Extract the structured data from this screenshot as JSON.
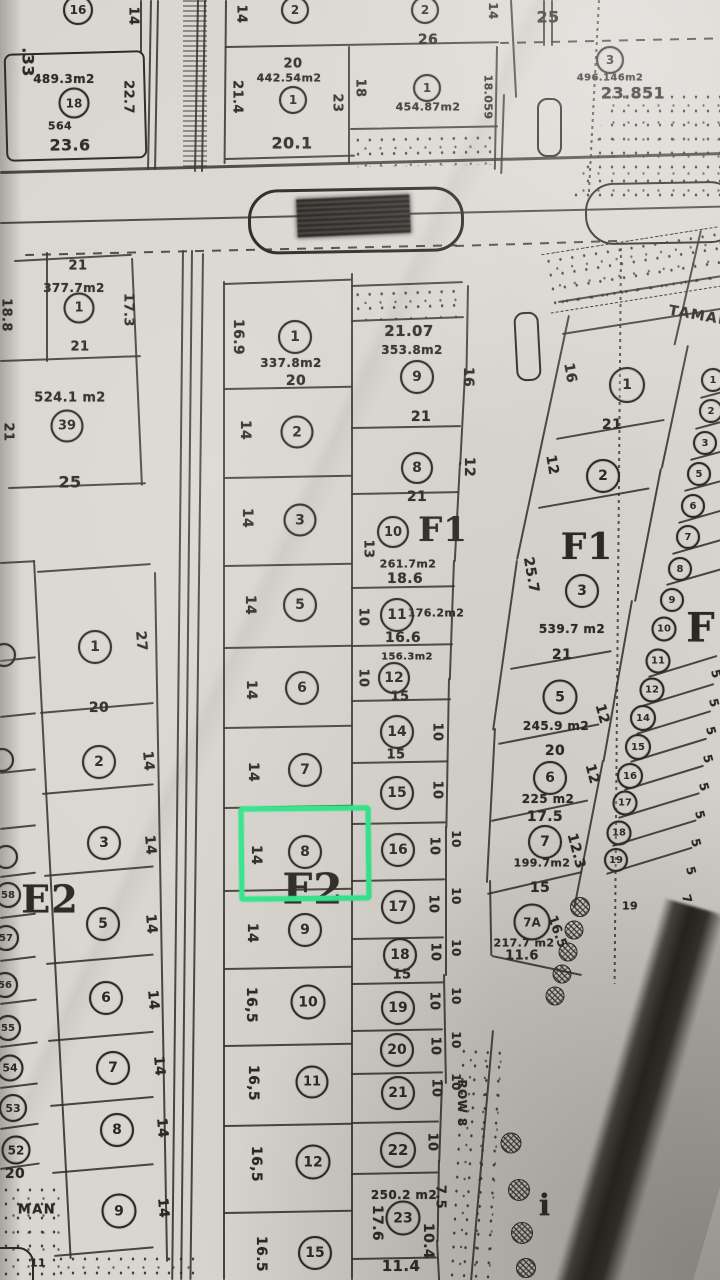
{
  "colors": {
    "paper": "#d9d6d0",
    "ink": "#2b2823",
    "highlight": "#2fe98b"
  },
  "highlight": {
    "plot": "8",
    "x": 239,
    "y": 806,
    "w": 122,
    "h": 85
  },
  "street": {
    "name_top": "TAMAN",
    "name_bottom_fragment": "MAN",
    "row_label": "ROW 8"
  },
  "texts": [
    {
      "t": ".33",
      "x": 28,
      "y": 62,
      "r": 90,
      "s": 16
    },
    {
      "t": "14",
      "x": 133,
      "y": 16,
      "r": 90,
      "s": 13
    },
    {
      "t": "489.3m2",
      "x": 64,
      "y": 79,
      "s": 12
    },
    {
      "t": "564",
      "x": 60,
      "y": 126,
      "s": 11
    },
    {
      "t": "23.6",
      "x": 70,
      "y": 145,
      "s": 16
    },
    {
      "t": "22.7",
      "x": 128,
      "y": 97,
      "r": 90,
      "s": 13
    },
    {
      "t": "21.4",
      "x": 237,
      "y": 97,
      "r": 90,
      "s": 13
    },
    {
      "t": "14",
      "x": 241,
      "y": 14,
      "r": 90,
      "s": 13
    },
    {
      "t": "26",
      "x": 428,
      "y": 40,
      "s": 14
    },
    {
      "t": "20",
      "x": 293,
      "y": 64,
      "s": 13
    },
    {
      "t": "442.54m2",
      "x": 289,
      "y": 78,
      "s": 11
    },
    {
      "t": "23",
      "x": 337,
      "y": 103,
      "r": 90,
      "s": 13
    },
    {
      "t": "20.1",
      "x": 292,
      "y": 143,
      "s": 16
    },
    {
      "t": "18",
      "x": 360,
      "y": 88,
      "r": 90,
      "s": 13
    },
    {
      "t": "454.87m2",
      "x": 428,
      "y": 107,
      "s": 11
    },
    {
      "t": "18.059",
      "x": 488,
      "y": 97,
      "r": 90,
      "s": 11
    },
    {
      "t": "14",
      "x": 493,
      "y": 11,
      "r": 90,
      "s": 12
    },
    {
      "t": "25",
      "x": 548,
      "y": 17,
      "s": 16
    },
    {
      "t": "496.146m2",
      "x": 610,
      "y": 78,
      "s": 10
    },
    {
      "t": "23.851",
      "x": 633,
      "y": 93,
      "s": 16
    },
    {
      "t": "21",
      "x": 78,
      "y": 266,
      "s": 13
    },
    {
      "t": "377.7m2",
      "x": 74,
      "y": 288,
      "s": 12
    },
    {
      "t": "17.3",
      "x": 128,
      "y": 310,
      "r": 90,
      "s": 13
    },
    {
      "t": "18.8",
      "x": 6,
      "y": 315,
      "r": 90,
      "s": 13
    },
    {
      "t": "21",
      "x": 80,
      "y": 347,
      "s": 13
    },
    {
      "t": "524.1 m2",
      "x": 70,
      "y": 398,
      "s": 13
    },
    {
      "t": "21",
      "x": 8,
      "y": 432,
      "r": 90,
      "s": 13
    },
    {
      "t": "25",
      "x": 70,
      "y": 482,
      "s": 16
    },
    {
      "t": "16.9",
      "x": 238,
      "y": 337,
      "r": 90,
      "s": 14
    },
    {
      "t": "337.8m2",
      "x": 291,
      "y": 363,
      "s": 12
    },
    {
      "t": "20",
      "x": 296,
      "y": 381,
      "s": 14
    },
    {
      "t": "14",
      "x": 245,
      "y": 430,
      "r": 90,
      "s": 14
    },
    {
      "t": "14",
      "x": 247,
      "y": 518,
      "r": 90,
      "s": 14
    },
    {
      "t": "14",
      "x": 250,
      "y": 605,
      "r": 90,
      "s": 14
    },
    {
      "t": "14",
      "x": 251,
      "y": 690,
      "r": 90,
      "s": 14
    },
    {
      "t": "14",
      "x": 253,
      "y": 772,
      "r": 90,
      "s": 14
    },
    {
      "t": "14",
      "x": 256,
      "y": 855,
      "r": 90,
      "s": 14
    },
    {
      "t": "14",
      "x": 252,
      "y": 933,
      "r": 90,
      "s": 14
    },
    {
      "t": "16,5",
      "x": 251,
      "y": 1005,
      "r": 90,
      "s": 14
    },
    {
      "t": "16,5",
      "x": 253,
      "y": 1083,
      "r": 90,
      "s": 14
    },
    {
      "t": "16,5",
      "x": 256,
      "y": 1164,
      "r": 90,
      "s": 14
    },
    {
      "t": "16.5",
      "x": 261,
      "y": 1254,
      "r": 90,
      "s": 14
    },
    {
      "t": "21.07",
      "x": 409,
      "y": 331,
      "s": 15
    },
    {
      "t": "353.8m2",
      "x": 412,
      "y": 350,
      "s": 12
    },
    {
      "t": "16",
      "x": 468,
      "y": 377,
      "r": 90,
      "s": 14
    },
    {
      "t": "21",
      "x": 421,
      "y": 417,
      "s": 14
    },
    {
      "t": "12",
      "x": 469,
      "y": 467,
      "r": 90,
      "s": 14
    },
    {
      "t": "21",
      "x": 417,
      "y": 497,
      "s": 14
    },
    {
      "t": "13",
      "x": 368,
      "y": 549,
      "r": 90,
      "s": 13
    },
    {
      "t": "261.7m2",
      "x": 408,
      "y": 564,
      "s": 11
    },
    {
      "t": "18.6",
      "x": 405,
      "y": 579,
      "s": 14
    },
    {
      "t": "176.2m2",
      "x": 436,
      "y": 613,
      "s": 11
    },
    {
      "t": "10",
      "x": 363,
      "y": 617,
      "r": 90,
      "s": 13
    },
    {
      "t": "16.6",
      "x": 403,
      "y": 638,
      "s": 14
    },
    {
      "t": "156.3m2",
      "x": 407,
      "y": 657,
      "s": 10
    },
    {
      "t": "10",
      "x": 363,
      "y": 678,
      "r": 90,
      "s": 13
    },
    {
      "t": "15",
      "x": 400,
      "y": 697,
      "s": 13
    },
    {
      "t": "10",
      "x": 437,
      "y": 732,
      "r": 90,
      "s": 13
    },
    {
      "t": "15",
      "x": 396,
      "y": 755,
      "s": 13
    },
    {
      "t": "10",
      "x": 437,
      "y": 790,
      "r": 90,
      "s": 13
    },
    {
      "t": "10",
      "x": 434,
      "y": 846,
      "r": 90,
      "s": 13
    },
    {
      "t": "10",
      "x": 456,
      "y": 839,
      "r": 90,
      "s": 12
    },
    {
      "t": "10",
      "x": 433,
      "y": 904,
      "r": 90,
      "s": 13
    },
    {
      "t": "10",
      "x": 456,
      "y": 896,
      "r": 90,
      "s": 12
    },
    {
      "t": "15",
      "x": 402,
      "y": 975,
      "s": 13
    },
    {
      "t": "10",
      "x": 435,
      "y": 952,
      "r": 90,
      "s": 13
    },
    {
      "t": "10",
      "x": 456,
      "y": 948,
      "r": 90,
      "s": 12
    },
    {
      "t": "10",
      "x": 434,
      "y": 1001,
      "r": 90,
      "s": 13
    },
    {
      "t": "10",
      "x": 456,
      "y": 996,
      "r": 90,
      "s": 12
    },
    {
      "t": "10",
      "x": 435,
      "y": 1046,
      "r": 90,
      "s": 13
    },
    {
      "t": "10",
      "x": 456,
      "y": 1040,
      "r": 90,
      "s": 12
    },
    {
      "t": "10",
      "x": 436,
      "y": 1088,
      "r": 90,
      "s": 13
    },
    {
      "t": "10",
      "x": 456,
      "y": 1082,
      "r": 90,
      "s": 12
    },
    {
      "t": "10",
      "x": 432,
      "y": 1142,
      "r": 90,
      "s": 13
    },
    {
      "t": "250.2 m2",
      "x": 404,
      "y": 1195,
      "s": 12
    },
    {
      "t": "7.5",
      "x": 440,
      "y": 1197,
      "r": 90,
      "s": 13
    },
    {
      "t": "17.6",
      "x": 377,
      "y": 1223,
      "r": 90,
      "s": 14
    },
    {
      "t": "10.4",
      "x": 428,
      "y": 1241,
      "r": 90,
      "s": 14
    },
    {
      "t": "11.4",
      "x": 401,
      "y": 1266,
      "s": 15
    },
    {
      "t": "ROW 8",
      "x": 462,
      "y": 1103,
      "r": 90,
      "s": 12
    },
    {
      "t": "TAMAN",
      "x": 700,
      "y": 316,
      "r": 10,
      "s": 14,
      "c": "street"
    },
    {
      "t": "16",
      "x": 570,
      "y": 373,
      "r": 80,
      "s": 14
    },
    {
      "t": "21",
      "x": 612,
      "y": 425,
      "s": 14
    },
    {
      "t": "12",
      "x": 552,
      "y": 465,
      "r": 80,
      "s": 14
    },
    {
      "t": "25.7",
      "x": 531,
      "y": 575,
      "r": 80,
      "s": 14
    },
    {
      "t": "539.7 m2",
      "x": 572,
      "y": 629,
      "s": 12
    },
    {
      "t": "21",
      "x": 562,
      "y": 655,
      "s": 14
    },
    {
      "t": "245.9 m2",
      "x": 556,
      "y": 726,
      "s": 12
    },
    {
      "t": "12",
      "x": 602,
      "y": 714,
      "r": 75,
      "s": 14
    },
    {
      "t": "20",
      "x": 555,
      "y": 751,
      "s": 14
    },
    {
      "t": "12",
      "x": 592,
      "y": 774,
      "r": 75,
      "s": 14
    },
    {
      "t": "225 m2",
      "x": 548,
      "y": 799,
      "s": 12
    },
    {
      "t": "17.5",
      "x": 545,
      "y": 817,
      "s": 14
    },
    {
      "t": "199.7m2",
      "x": 542,
      "y": 863,
      "s": 11
    },
    {
      "t": "12.3",
      "x": 576,
      "y": 851,
      "r": 75,
      "s": 14
    },
    {
      "t": "15",
      "x": 540,
      "y": 888,
      "s": 14
    },
    {
      "t": "217.7 m2",
      "x": 524,
      "y": 943,
      "s": 11
    },
    {
      "t": "11.6",
      "x": 522,
      "y": 956,
      "s": 13
    },
    {
      "t": "16.5",
      "x": 557,
      "y": 932,
      "r": 70,
      "s": 13
    },
    {
      "t": "19",
      "x": 630,
      "y": 906,
      "s": 11
    },
    {
      "t": "MAN",
      "x": 37,
      "y": 1210,
      "s": 13,
      "c": "street"
    },
    {
      "t": "20",
      "x": 15,
      "y": 1174,
      "s": 14
    },
    {
      "t": "11",
      "x": 38,
      "y": 1263,
      "s": 11
    },
    {
      "t": "27",
      "x": 141,
      "y": 641,
      "r": 85,
      "s": 14
    },
    {
      "t": "20",
      "x": 99,
      "y": 708,
      "s": 14
    },
    {
      "t": "14",
      "x": 148,
      "y": 761,
      "r": 85,
      "s": 14
    },
    {
      "t": "14",
      "x": 150,
      "y": 845,
      "r": 85,
      "s": 14
    },
    {
      "t": "14",
      "x": 151,
      "y": 924,
      "r": 85,
      "s": 14
    },
    {
      "t": "14",
      "x": 153,
      "y": 1000,
      "r": 85,
      "s": 14
    },
    {
      "t": "14",
      "x": 159,
      "y": 1066,
      "r": 85,
      "s": 14
    },
    {
      "t": "14",
      "x": 162,
      "y": 1128,
      "r": 85,
      "s": 14
    },
    {
      "t": "14",
      "x": 163,
      "y": 1208,
      "r": 85,
      "s": 14
    },
    {
      "t": "5",
      "x": 716,
      "y": 674,
      "r": 75,
      "s": 12
    },
    {
      "t": "5",
      "x": 714,
      "y": 703,
      "r": 75,
      "s": 12
    },
    {
      "t": "5",
      "x": 711,
      "y": 731,
      "r": 75,
      "s": 12
    },
    {
      "t": "5",
      "x": 708,
      "y": 759,
      "r": 75,
      "s": 12
    },
    {
      "t": "5",
      "x": 704,
      "y": 787,
      "r": 75,
      "s": 12
    },
    {
      "t": "5",
      "x": 700,
      "y": 815,
      "r": 75,
      "s": 12
    },
    {
      "t": "5",
      "x": 696,
      "y": 843,
      "r": 75,
      "s": 12
    },
    {
      "t": "5",
      "x": 691,
      "y": 871,
      "r": 75,
      "s": 12
    },
    {
      "t": "7",
      "x": 687,
      "y": 899,
      "r": 75,
      "s": 12
    },
    {
      "t": "E2",
      "x": 50,
      "y": 899,
      "s": 38,
      "c": "big"
    },
    {
      "t": "F2",
      "x": 313,
      "y": 889,
      "s": 42,
      "c": "big"
    },
    {
      "t": "F1",
      "x": 443,
      "y": 530,
      "s": 34,
      "c": "big"
    },
    {
      "t": "F1",
      "x": 587,
      "y": 547,
      "s": 36,
      "c": "big"
    },
    {
      "t": "F",
      "x": 701,
      "y": 628,
      "s": 40,
      "c": "big"
    },
    {
      "t": "i",
      "x": 545,
      "y": 1206,
      "s": 30,
      "c": "big"
    }
  ],
  "circles": [
    {
      "n": "16",
      "x": 78,
      "y": 10,
      "d": 26,
      "fs": 12
    },
    {
      "n": "2",
      "x": 295,
      "y": 10,
      "d": 24,
      "fs": 12
    },
    {
      "n": "2",
      "x": 425,
      "y": 10,
      "d": 24,
      "fs": 12
    },
    {
      "n": "1",
      "x": 293,
      "y": 100,
      "d": 24,
      "fs": 12
    },
    {
      "n": "1",
      "x": 427,
      "y": 88,
      "d": 24,
      "fs": 12
    },
    {
      "n": "18",
      "x": 74,
      "y": 103,
      "d": 27,
      "fs": 12
    },
    {
      "n": "3",
      "x": 610,
      "y": 60,
      "d": 24,
      "fs": 12
    },
    {
      "n": "1",
      "x": 79,
      "y": 308,
      "d": 27,
      "fs": 13
    },
    {
      "n": "39",
      "x": 67,
      "y": 426,
      "d": 29,
      "fs": 13
    },
    {
      "n": "1",
      "x": 295,
      "y": 337,
      "d": 30,
      "fs": 14
    },
    {
      "n": "2",
      "x": 297,
      "y": 432,
      "d": 29,
      "fs": 14
    },
    {
      "n": "3",
      "x": 300,
      "y": 520,
      "d": 29,
      "fs": 14
    },
    {
      "n": "5",
      "x": 300,
      "y": 605,
      "d": 30,
      "fs": 14
    },
    {
      "n": "6",
      "x": 302,
      "y": 688,
      "d": 30,
      "fs": 14
    },
    {
      "n": "7",
      "x": 305,
      "y": 770,
      "d": 30,
      "fs": 14
    },
    {
      "n": "8",
      "x": 305,
      "y": 852,
      "d": 30,
      "fs": 14
    },
    {
      "n": "9",
      "x": 305,
      "y": 930,
      "d": 30,
      "fs": 14
    },
    {
      "n": "10",
      "x": 308,
      "y": 1002,
      "d": 31,
      "fs": 14
    },
    {
      "n": "11",
      "x": 312,
      "y": 1082,
      "d": 29,
      "fs": 13
    },
    {
      "n": "12",
      "x": 313,
      "y": 1162,
      "d": 31,
      "fs": 14
    },
    {
      "n": "15",
      "x": 315,
      "y": 1253,
      "d": 30,
      "fs": 14
    },
    {
      "n": "9",
      "x": 417,
      "y": 377,
      "d": 30,
      "fs": 14
    },
    {
      "n": "8",
      "x": 417,
      "y": 468,
      "d": 28,
      "fs": 14
    },
    {
      "n": "10",
      "x": 393,
      "y": 532,
      "d": 28,
      "fs": 13
    },
    {
      "n": "11",
      "x": 397,
      "y": 615,
      "d": 30,
      "fs": 14
    },
    {
      "n": "12",
      "x": 394,
      "y": 678,
      "d": 28,
      "fs": 14
    },
    {
      "n": "14",
      "x": 397,
      "y": 732,
      "d": 30,
      "fs": 14
    },
    {
      "n": "15",
      "x": 397,
      "y": 793,
      "d": 30,
      "fs": 14
    },
    {
      "n": "16",
      "x": 398,
      "y": 850,
      "d": 30,
      "fs": 14
    },
    {
      "n": "17",
      "x": 398,
      "y": 907,
      "d": 30,
      "fs": 14
    },
    {
      "n": "18",
      "x": 400,
      "y": 955,
      "d": 30,
      "fs": 14
    },
    {
      "n": "19",
      "x": 398,
      "y": 1008,
      "d": 30,
      "fs": 14
    },
    {
      "n": "20",
      "x": 397,
      "y": 1050,
      "d": 30,
      "fs": 14
    },
    {
      "n": "21",
      "x": 398,
      "y": 1093,
      "d": 30,
      "fs": 14
    },
    {
      "n": "22",
      "x": 398,
      "y": 1150,
      "d": 32,
      "fs": 15
    },
    {
      "n": "23",
      "x": 403,
      "y": 1218,
      "d": 31,
      "fs": 14
    },
    {
      "n": "1",
      "x": 627,
      "y": 385,
      "d": 32,
      "fs": 14
    },
    {
      "n": "2",
      "x": 603,
      "y": 476,
      "d": 30,
      "fs": 14
    },
    {
      "n": "3",
      "x": 582,
      "y": 591,
      "d": 30,
      "fs": 14
    },
    {
      "n": "5",
      "x": 560,
      "y": 697,
      "d": 31,
      "fs": 14
    },
    {
      "n": "6",
      "x": 550,
      "y": 778,
      "d": 30,
      "fs": 14
    },
    {
      "n": "7",
      "x": 545,
      "y": 842,
      "d": 30,
      "fs": 14
    },
    {
      "n": "7A",
      "x": 532,
      "y": 922,
      "d": 33,
      "fs": 12
    },
    {
      "n": "1",
      "x": 713,
      "y": 380,
      "d": 20,
      "fs": 10
    },
    {
      "n": "2",
      "x": 711,
      "y": 411,
      "d": 20,
      "fs": 10
    },
    {
      "n": "3",
      "x": 705,
      "y": 443,
      "d": 20,
      "fs": 10
    },
    {
      "n": "5",
      "x": 699,
      "y": 474,
      "d": 20,
      "fs": 10
    },
    {
      "n": "6",
      "x": 693,
      "y": 506,
      "d": 20,
      "fs": 10
    },
    {
      "n": "7",
      "x": 688,
      "y": 537,
      "d": 20,
      "fs": 10
    },
    {
      "n": "8",
      "x": 680,
      "y": 569,
      "d": 20,
      "fs": 10
    },
    {
      "n": "9",
      "x": 672,
      "y": 600,
      "d": 20,
      "fs": 10
    },
    {
      "n": "10",
      "x": 664,
      "y": 629,
      "d": 21,
      "fs": 10
    },
    {
      "n": "11",
      "x": 658,
      "y": 661,
      "d": 21,
      "fs": 10
    },
    {
      "n": "12",
      "x": 652,
      "y": 690,
      "d": 21,
      "fs": 10
    },
    {
      "n": "14",
      "x": 643,
      "y": 718,
      "d": 22,
      "fs": 10
    },
    {
      "n": "15",
      "x": 638,
      "y": 747,
      "d": 22,
      "fs": 10
    },
    {
      "n": "16",
      "x": 630,
      "y": 776,
      "d": 22,
      "fs": 10
    },
    {
      "n": "17",
      "x": 625,
      "y": 803,
      "d": 21,
      "fs": 10
    },
    {
      "n": "18",
      "x": 619,
      "y": 833,
      "d": 21,
      "fs": 10
    },
    {
      "n": "19",
      "x": 616,
      "y": 860,
      "d": 20,
      "fs": 10
    },
    {
      "n": "1",
      "x": 95,
      "y": 647,
      "d": 30,
      "fs": 14
    },
    {
      "n": "2",
      "x": 99,
      "y": 762,
      "d": 30,
      "fs": 14
    },
    {
      "n": "3",
      "x": 104,
      "y": 843,
      "d": 30,
      "fs": 14
    },
    {
      "n": "5",
      "x": 103,
      "y": 924,
      "d": 30,
      "fs": 14
    },
    {
      "n": "6",
      "x": 106,
      "y": 998,
      "d": 30,
      "fs": 14
    },
    {
      "n": "7",
      "x": 113,
      "y": 1068,
      "d": 30,
      "fs": 14
    },
    {
      "n": "8",
      "x": 117,
      "y": 1130,
      "d": 30,
      "fs": 14
    },
    {
      "n": "9",
      "x": 119,
      "y": 1211,
      "d": 31,
      "fs": 14
    },
    {
      "n": "58",
      "x": 8,
      "y": 895,
      "d": 22,
      "fs": 10
    },
    {
      "n": "57",
      "x": 6,
      "y": 938,
      "d": 22,
      "fs": 10
    },
    {
      "n": "56",
      "x": 5,
      "y": 985,
      "d": 22,
      "fs": 10
    },
    {
      "n": "55",
      "x": 8,
      "y": 1028,
      "d": 22,
      "fs": 10
    },
    {
      "n": "54",
      "x": 10,
      "y": 1068,
      "d": 23,
      "fs": 11
    },
    {
      "n": "53",
      "x": 13,
      "y": 1108,
      "d": 24,
      "fs": 11
    },
    {
      "n": "52",
      "x": 16,
      "y": 1150,
      "d": 25,
      "fs": 12
    },
    {
      "n": "",
      "x": 4,
      "y": 655,
      "d": 20,
      "fs": 10
    },
    {
      "n": "",
      "x": 2,
      "y": 760,
      "d": 20,
      "fs": 10
    },
    {
      "n": "",
      "x": 6,
      "y": 857,
      "d": 20,
      "fs": 10
    }
  ]
}
